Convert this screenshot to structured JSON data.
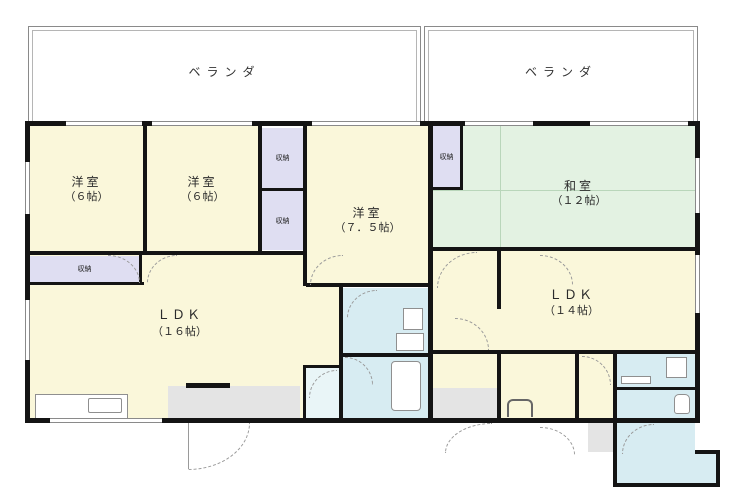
{
  "balconies": {
    "left": "ベランダ",
    "right": "ベランダ"
  },
  "rooms": {
    "yoshitsu1": {
      "name": "洋室",
      "size": "（６帖）"
    },
    "yoshitsu2": {
      "name": "洋室",
      "size": "（６帖）"
    },
    "yoshitsu3": {
      "name": "洋室",
      "size": "（７．５帖）"
    },
    "washitsu": {
      "name": "和室",
      "size": "（１２帖）"
    },
    "ldk_left": {
      "name": "ＬＤＫ",
      "size": "（１６帖）"
    },
    "ldk_right": {
      "name": "ＬＤＫ",
      "size": "（１４帖）"
    }
  },
  "closets": {
    "top": "収納",
    "bottom": "収納",
    "wide": "収納",
    "right": "収納"
  },
  "colors": {
    "room_yellow": "#faf7da",
    "tatami_green": "#e3f2e2",
    "closet_lavender": "#dfdef2",
    "bath_cyan": "#d7ecf2",
    "hall_gray": "#e4e4e4",
    "wall_black": "#141414"
  }
}
